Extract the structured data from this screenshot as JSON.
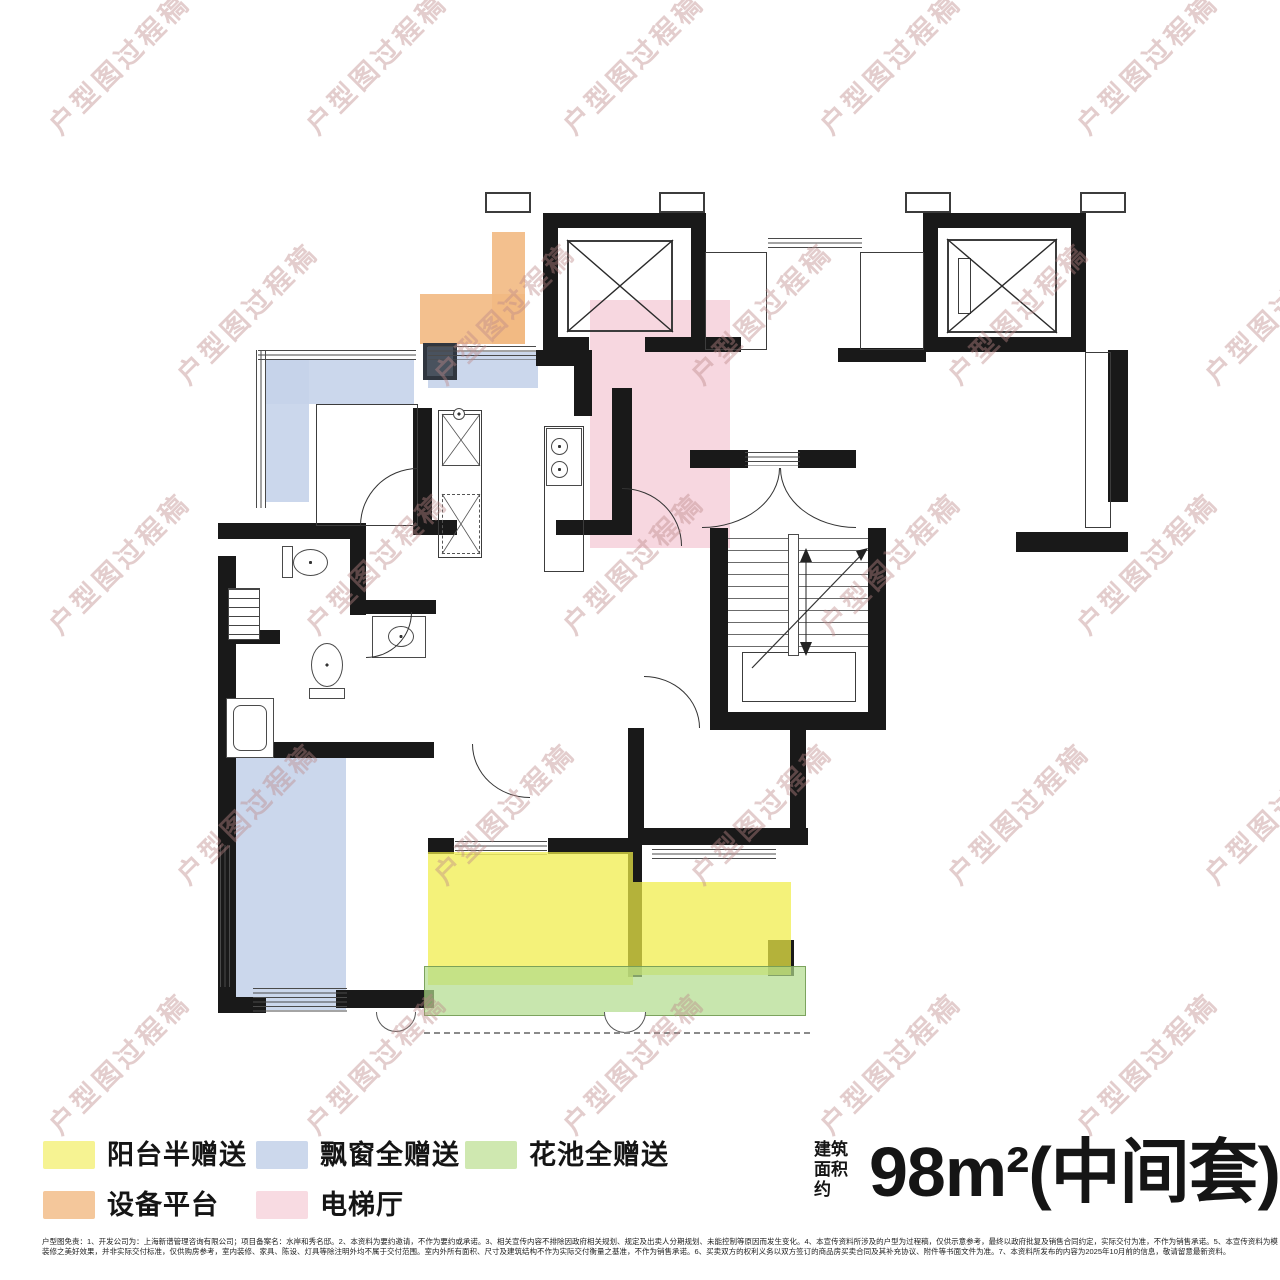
{
  "watermark": {
    "text": "户型图过程稿",
    "color": "rgba(188,136,136,0.42)"
  },
  "legend": {
    "items": [
      {
        "label": "阳台半赠送",
        "color": "#f6f392"
      },
      {
        "label": "飘窗全赠送",
        "color": "#ccd8ec"
      },
      {
        "label": "花池全赠送",
        "color": "#cfe8b0"
      },
      {
        "label": "设备平台",
        "color": "#f4c79b"
      },
      {
        "label": "电梯厅",
        "color": "#f8dbe2"
      }
    ]
  },
  "area_info": {
    "label_line1": "建筑",
    "label_line2": "面积约",
    "value": "98m²(中间套)"
  },
  "plan_zone_colors": {
    "equipment_platform": "rgba(242,185,130,0.9)",
    "bay_window": "rgba(197,211,234,0.9)",
    "elevator_hall": "rgba(247,213,222,0.95)",
    "balcony": "rgba(240,237,70,0.72)",
    "flower_bed": "rgba(177,219,140,0.7)"
  },
  "disclaimer": {
    "line1": "户型图免责：1、开发公司为：上海新谱管理咨询有限公司；项目备案名：水岸和秀名邸。2、本资料为要约邀请，不作为要约或承诺。3、相关宣传内容不排除因政府相关规划、规定及出卖人分期规划、未能控制等原因而发生变化。4、本宣传资料所涉及的户型为过程稿，仅供示意参考，最终以政府批复及销售合同约定，实际交付为准，不作为销售承诺。5、本宣传资料为模拟户型",
    "line2": "装修之美好效果，并非实际交付标准，仅供购房参考，室内装修、家具、陈设、灯具等除注明外均不属于交付范围。室内外所有面积、尺寸及建筑结构不作为实际交付衡量之基准，不作为销售承诺。6、买卖双方的权利义务以双方签订的商品房买卖合同及其补充协议、附件等书面文件为准。7、本资料所发布的内容为2025年10月前的信息，敬请留意最新资料。"
  }
}
